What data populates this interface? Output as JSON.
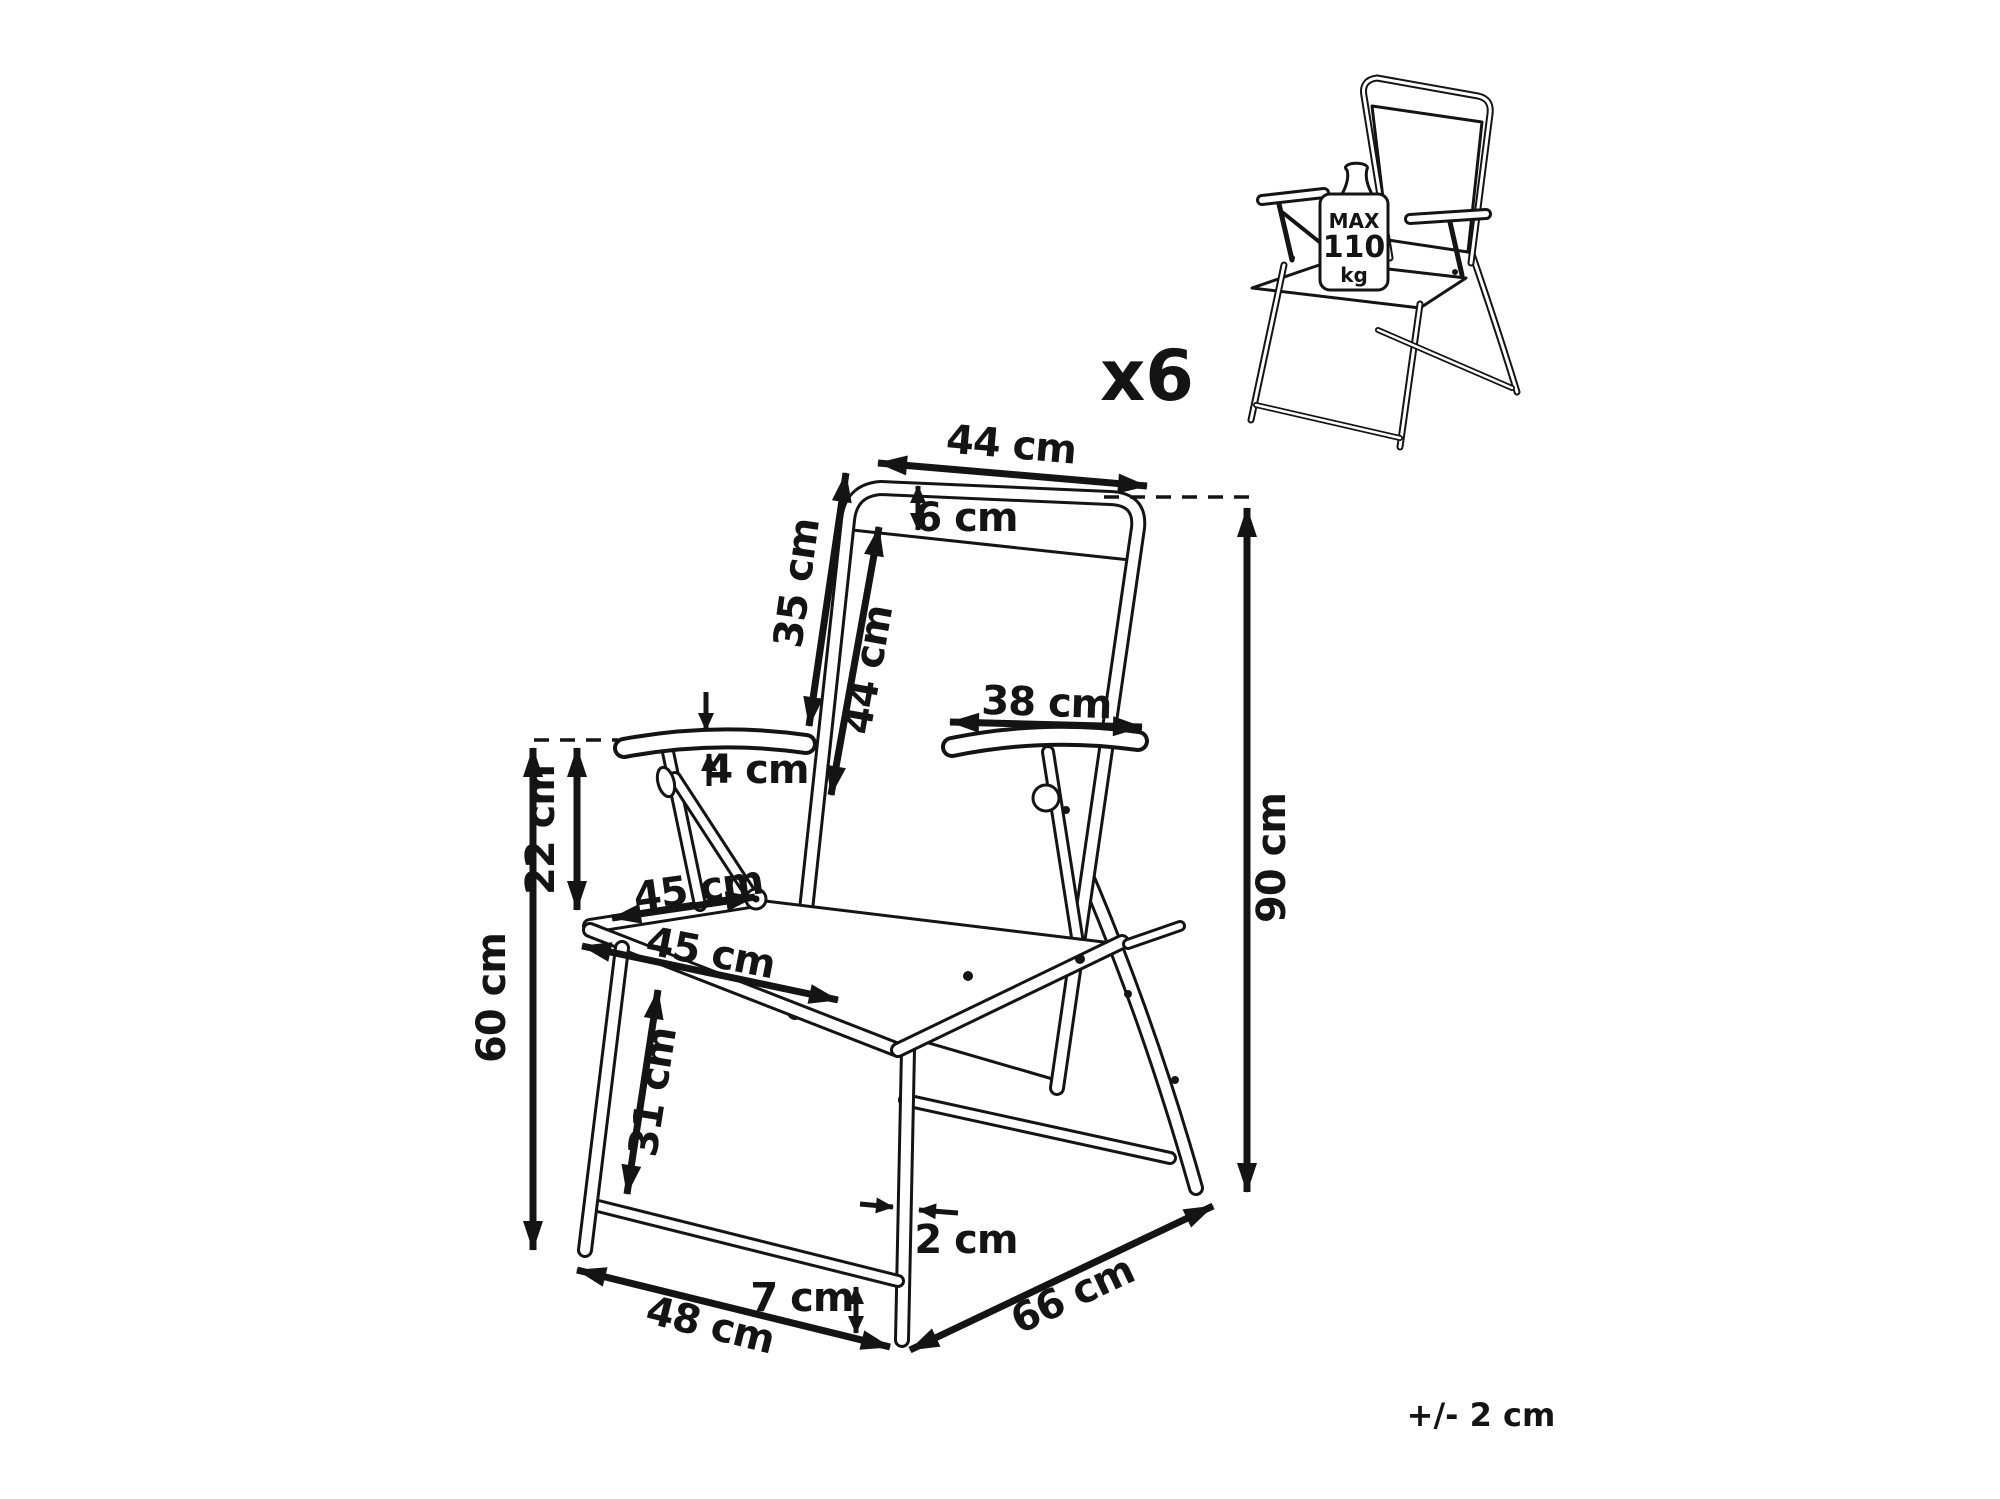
{
  "product": {
    "quantity_label": "x6",
    "tolerance_note": "+/- 2 cm",
    "max_load": {
      "line1": "MAX",
      "line2": "110",
      "line3": "kg"
    }
  },
  "dimensions": {
    "back_top_width": "44 cm",
    "headrest_height": "6 cm",
    "back_upper_length": "35 cm",
    "back_fabric_length": "44 cm",
    "armrest_length": "38 cm",
    "armrest_thickness": "4 cm",
    "armrest_drop": "22 cm",
    "seat_depth": "45 cm",
    "seat_width": "45 cm",
    "armrest_height": "60 cm",
    "leg_clearance": "31 cm",
    "tube_diameter": "2 cm",
    "foot_height": "7 cm",
    "base_width": "48 cm",
    "base_depth": "66 cm",
    "total_height": "90 cm"
  },
  "colors": {
    "line": "#141414",
    "background": "#ffffff"
  }
}
